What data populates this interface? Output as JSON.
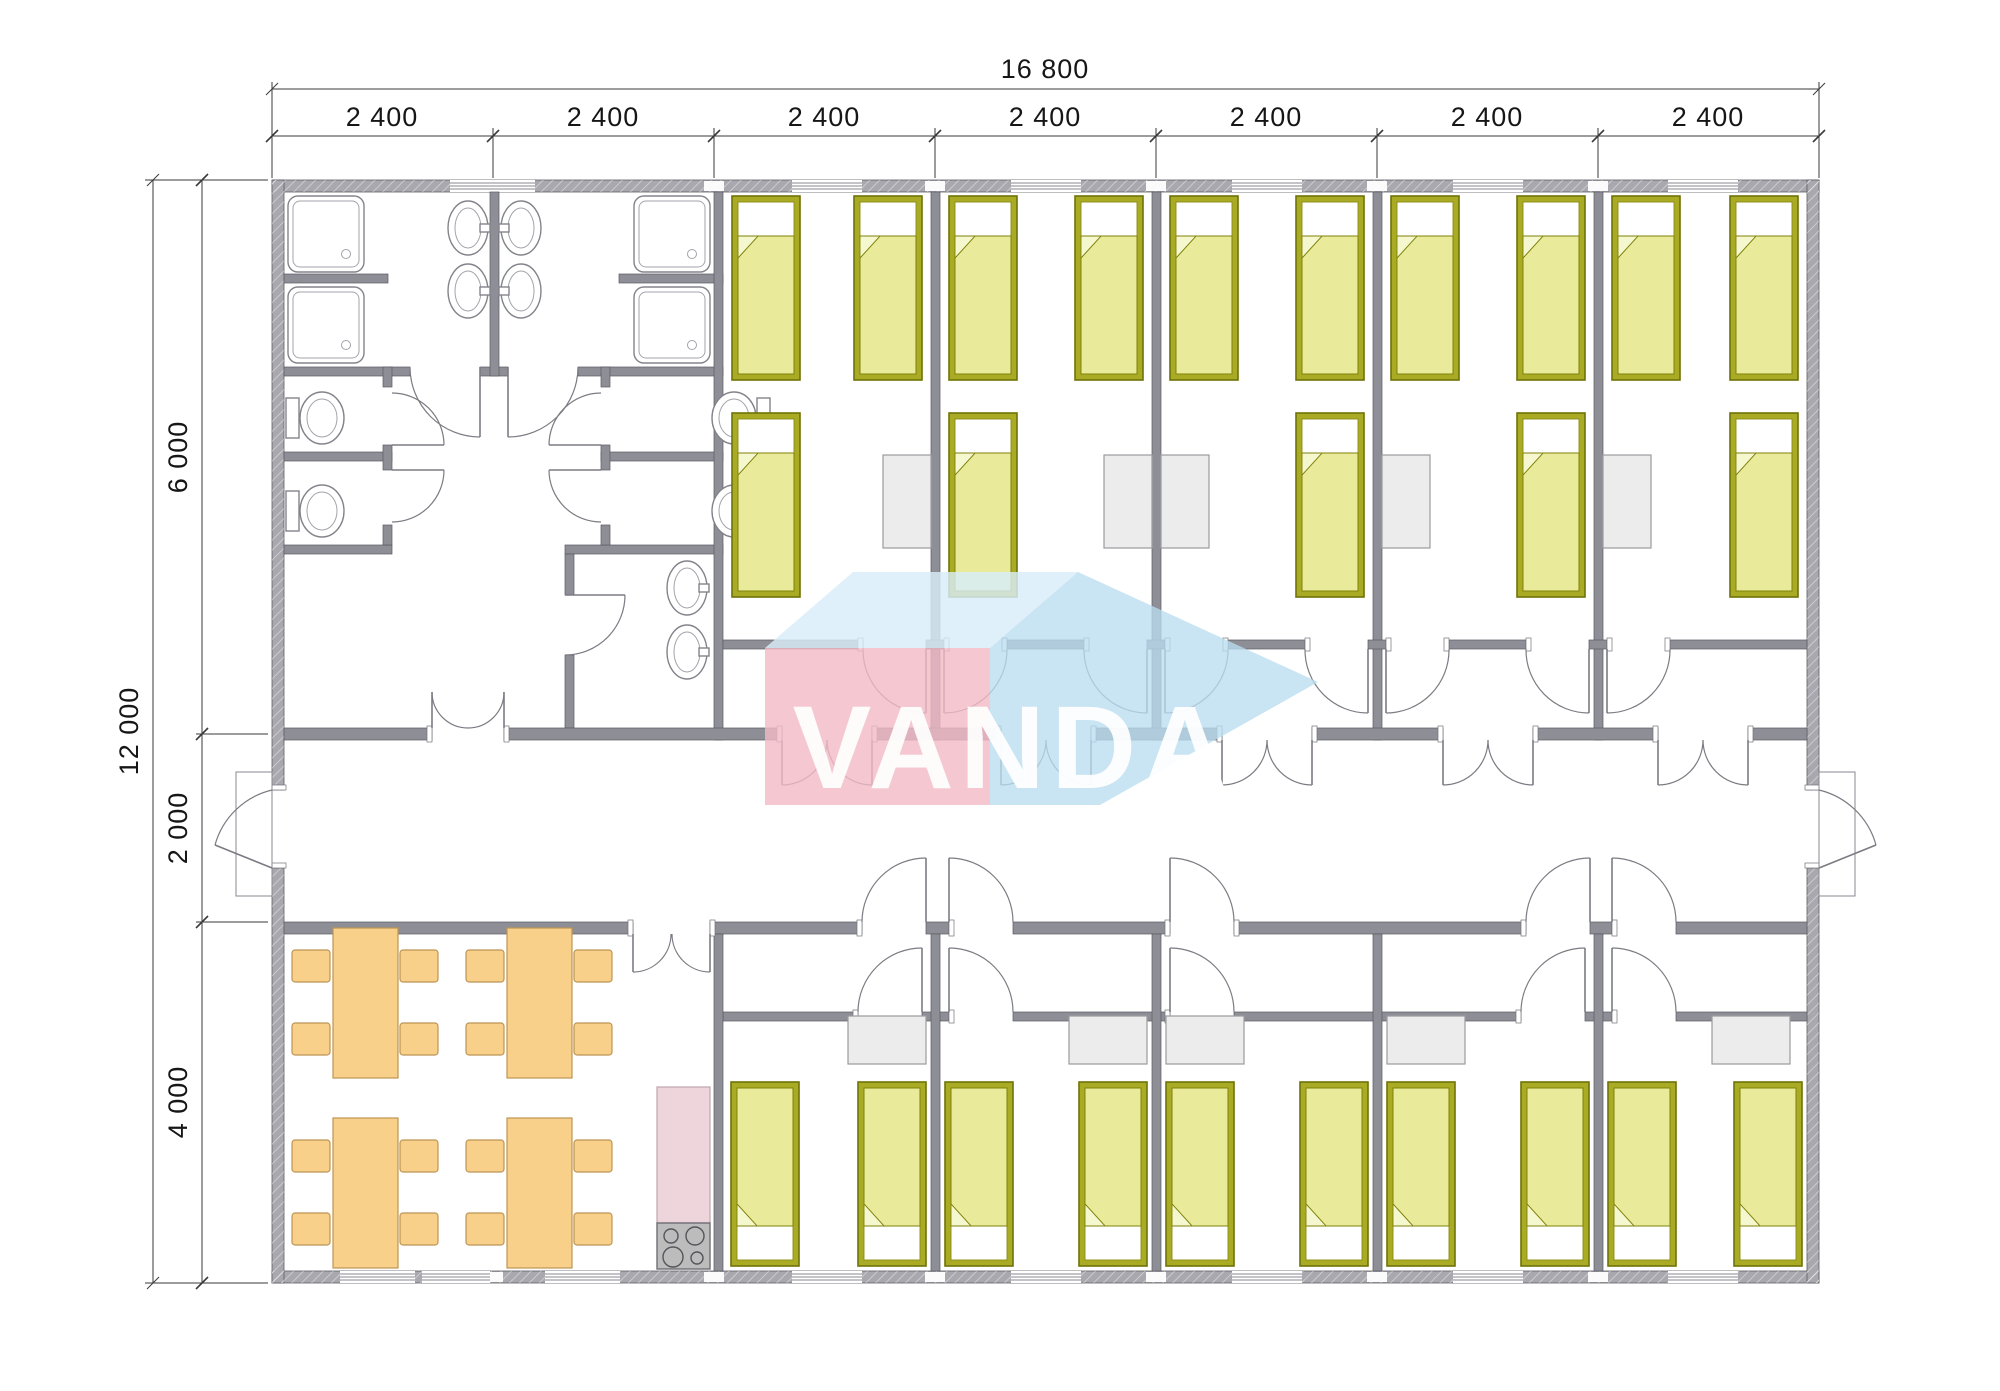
{
  "watermark": {
    "text": "VANDA",
    "pink": "#f3bac5",
    "blue_light": "#d8edf9",
    "blue_mid": "#badcee"
  },
  "dimensions": {
    "top_total": "16 800",
    "top_segments": [
      "2 400",
      "2 400",
      "2 400",
      "2 400",
      "2 400",
      "2 400",
      "2 400"
    ],
    "left_total": "12 000",
    "left_segments": [
      "6 000",
      "2 000",
      "4 000"
    ]
  },
  "plan": {
    "building": {
      "width_mm": 16800,
      "depth_mm": 12000,
      "modules": 7,
      "module_width_mm": 2400
    },
    "zones": {
      "top_band_depth_mm": 6000,
      "corridor_depth_mm": 2000,
      "bottom_band_depth_mm": 4000
    },
    "rooms": {
      "sanitary_block": {
        "showers": 4,
        "toilets": 4,
        "wash_basins": 6
      },
      "bedrooms_top": 5,
      "bedrooms_bottom": 5,
      "dining_room": {
        "tables": 4,
        "chairs": 16
      },
      "kitchen": {
        "counter": 1,
        "stove_burners": 4
      }
    },
    "furniture_counts": {
      "beds": 25,
      "bedside_tables": 10
    }
  },
  "colors": {
    "wall_exterior": "#a8a8ae",
    "wall_interior": "#8e8e96",
    "bed_frame": "#a9ab25",
    "bed_blanket": "#e9eb9b",
    "dining_furniture": "#f8d089",
    "kitchen_counter": "#eed5dc",
    "stove": "#bcbcbc",
    "table_gray": "#ececec"
  }
}
